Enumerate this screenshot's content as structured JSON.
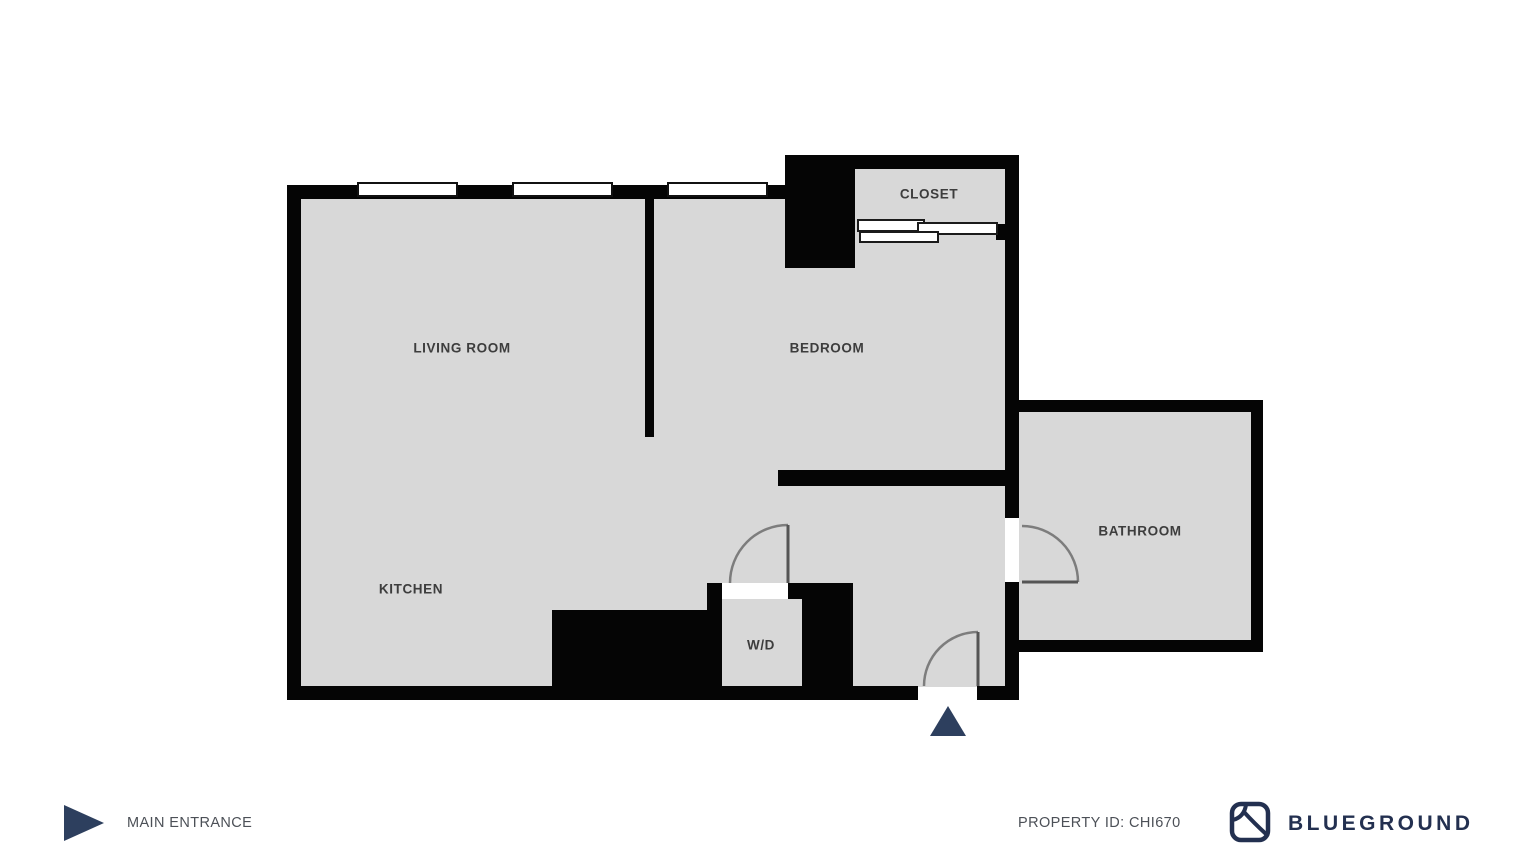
{
  "floorplan": {
    "rooms": [
      {
        "id": "living-room",
        "label": "LIVING ROOM"
      },
      {
        "id": "bedroom",
        "label": "BEDROOM"
      },
      {
        "id": "closet",
        "label": "CLOSET"
      },
      {
        "id": "bathroom",
        "label": "BATHROOM"
      },
      {
        "id": "kitchen",
        "label": "KITCHEN"
      },
      {
        "id": "washer-dryer",
        "label": "W/D"
      }
    ],
    "colors": {
      "wall": "#050505",
      "room_fill": "#d8d8d8",
      "door_arc": "#7d7d7d",
      "accent_navy": "#2d3f5e"
    }
  },
  "legend": {
    "main_entrance_label": "MAIN ENTRANCE"
  },
  "footer": {
    "property_id_label": "PROPERTY ID: CHI670",
    "brand_name": "BLUEGROUND"
  }
}
